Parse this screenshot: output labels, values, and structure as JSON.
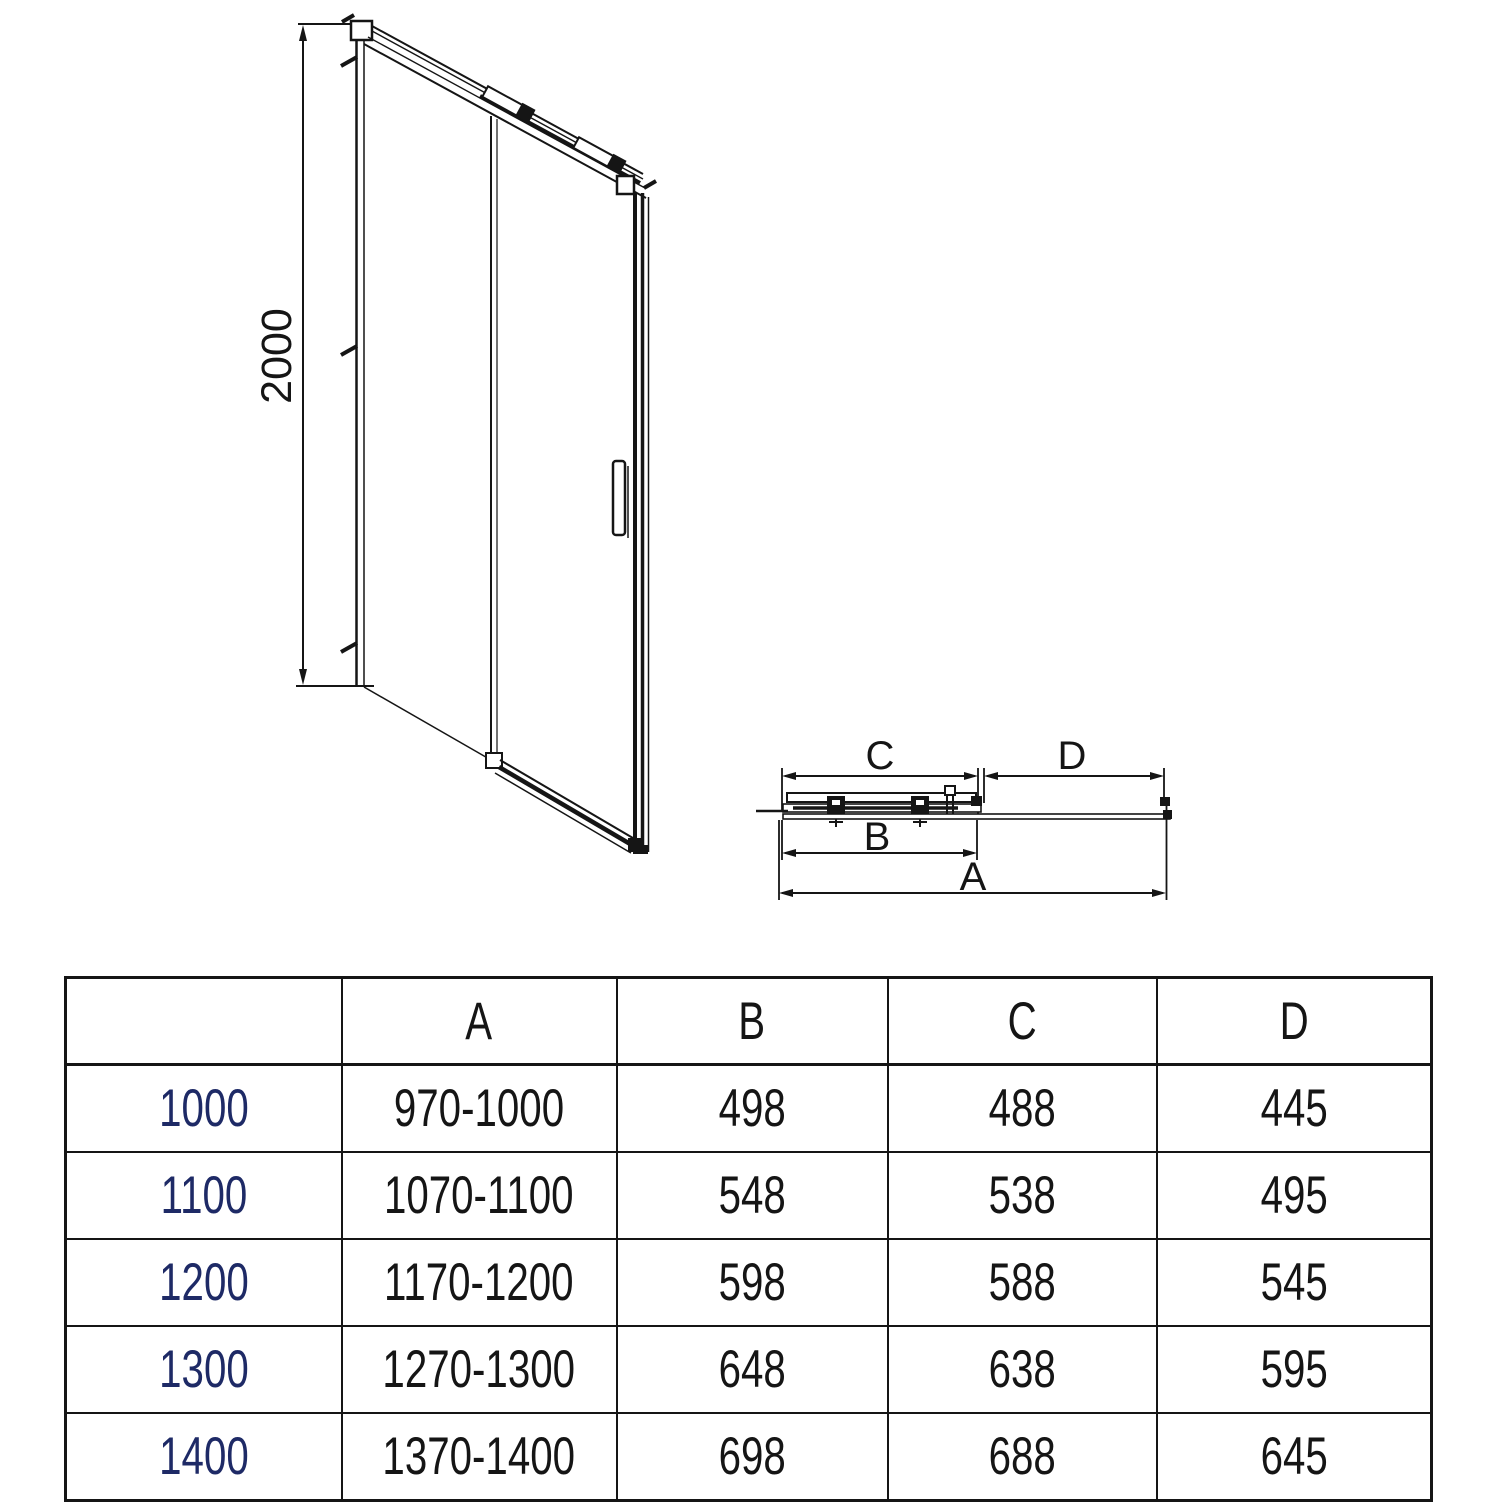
{
  "page": {
    "background": "#ffffff",
    "ink": "#151515",
    "size_column_color": "#1e2a66"
  },
  "front_view": {
    "height_label": "2000"
  },
  "plan_view": {
    "label_c": "C",
    "label_d": "D",
    "label_b": "B",
    "label_a": "A"
  },
  "table": {
    "columns": [
      "",
      "A",
      "B",
      "C",
      "D"
    ],
    "rows": [
      {
        "size": "1000",
        "a": "970-1000",
        "b": "498",
        "c": "488",
        "d": "445"
      },
      {
        "size": "1100",
        "a": "1070-1100",
        "b": "548",
        "c": "538",
        "d": "495"
      },
      {
        "size": "1200",
        "a": "1170-1200",
        "b": "598",
        "c": "588",
        "d": "545"
      },
      {
        "size": "1300",
        "a": "1270-1300",
        "b": "648",
        "c": "638",
        "d": "595"
      },
      {
        "size": "1400",
        "a": "1370-1400",
        "b": "698",
        "c": "688",
        "d": "645"
      }
    ]
  }
}
